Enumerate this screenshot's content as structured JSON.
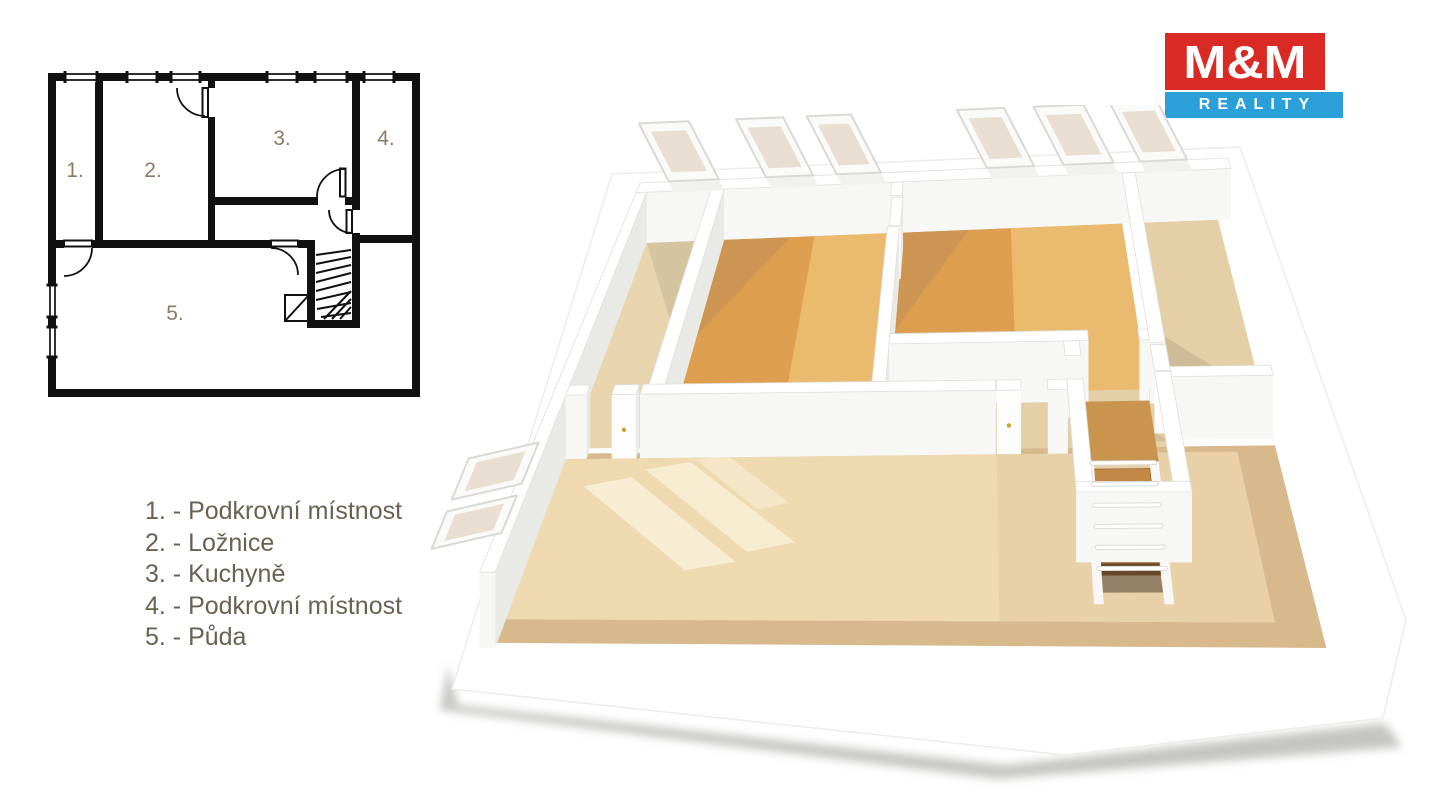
{
  "logo": {
    "top": "M&M",
    "bottom": "REALITY",
    "red": "#d92b23",
    "blue": "#2b9fd8"
  },
  "legend": {
    "items": [
      "1. - Podkrovní místnost",
      "2. - Ložnice",
      "3. - Kuchyně",
      "4. - Podkrovní místnost",
      "5. - Půda"
    ]
  },
  "plan2d": {
    "labels": [
      "1.",
      "2.",
      "3.",
      "4.",
      "5."
    ],
    "label_color": "#8b7c64"
  },
  "iso": {
    "quad": {
      "nw": [
        210,
        128
      ],
      "ne": [
        798,
        103
      ],
      "sw": [
        48,
        547
      ],
      "se": [
        918,
        553
      ]
    },
    "outline": [
      [
        182,
        69
      ],
      [
        810,
        42
      ],
      [
        976,
        515
      ],
      [
        953,
        613
      ],
      [
        635,
        650
      ],
      [
        22,
        584
      ]
    ],
    "ground_shadow": [
      [
        18,
        560
      ],
      [
        28,
        600
      ],
      [
        575,
        660
      ],
      [
        955,
        618
      ],
      [
        972,
        642
      ],
      [
        568,
        674
      ],
      [
        10,
        605
      ]
    ],
    "wall_h": [
      50,
      26
    ],
    "colors": {
      "wallFront": "#f7f7f5",
      "wallSide": "#e9e9e6",
      "wallTop": "#ffffff",
      "wallEdge": "#dededa",
      "woodLight": "#e8d4ad",
      "woodOrange": "#dd9e50",
      "woodOrangeLight": "#eaba6e",
      "woodTan": "#e4cfa7",
      "woodBand": "#d8b98c",
      "woodField": "#eed9b1",
      "stairWood": "#c9944e",
      "pane": "#e8dfd2",
      "frame": "#fafaf8",
      "frameEdge": "#d9d9d5",
      "door": "#fdfdfc",
      "handle": "#c9a227"
    },
    "floors": [
      {
        "n": "floor-room1",
        "r": [
          0.018,
          0.0247,
          0.126,
          0.515
        ],
        "c": "woodLight"
      },
      {
        "n": "floor-room2",
        "r": [
          0.148,
          0.0247,
          0.43,
          0.515
        ],
        "c": "woodOrange"
      },
      {
        "n": "floor-room2-light",
        "r": [
          0.3,
          0.0247,
          0.43,
          0.515
        ],
        "c": "woodOrangeLight"
      },
      {
        "n": "floor-room3",
        "r": [
          0.449,
          0.0247,
          0.817,
          0.398
        ],
        "c": "woodOrange"
      },
      {
        "n": "floor-room3-light",
        "r": [
          0.63,
          0.0247,
          0.817,
          0.398
        ],
        "c": "woodOrangeLight"
      },
      {
        "n": "floor-corridor",
        "r": [
          0.449,
          0.398,
          0.839,
          0.527
        ],
        "c": "woodTan"
      },
      {
        "n": "floor-room4",
        "r": [
          0.839,
          0.0247,
          0.978,
          0.5
        ],
        "c": "woodTan"
      },
      {
        "n": "floor-attic-band",
        "r": [
          0.018,
          0.527,
          0.978,
          0.978
        ],
        "c": "woodBand"
      },
      {
        "n": "floor-attic",
        "r": [
          0.018,
          0.54,
          0.925,
          0.922
        ],
        "c": "woodField"
      }
    ],
    "overlays": [
      {
        "n": "shade-attic-right",
        "p": [
          [
            0.6,
            0.54
          ],
          [
            0.925,
            0.54
          ],
          [
            0.925,
            0.922
          ],
          [
            0.6,
            0.922
          ]
        ],
        "f": "rgba(186,156,108,0.12)"
      },
      {
        "n": "sunlight-patch-1",
        "p": [
          [
            0.055,
            0.605
          ],
          [
            0.115,
            0.585
          ],
          [
            0.275,
            0.785
          ],
          [
            0.215,
            0.805
          ]
        ],
        "f": "rgba(255,250,233,0.6)"
      },
      {
        "n": "sunlight-patch-2",
        "p": [
          [
            0.13,
            0.567
          ],
          [
            0.188,
            0.55
          ],
          [
            0.345,
            0.74
          ],
          [
            0.287,
            0.762
          ]
        ],
        "f": "rgba(255,250,233,0.55)"
      },
      {
        "n": "sunlight-patch-3",
        "p": [
          [
            0.195,
            0.545
          ],
          [
            0.235,
            0.535
          ],
          [
            0.33,
            0.648
          ],
          [
            0.29,
            0.663
          ]
        ],
        "f": "rgba(255,250,233,0.4)"
      },
      {
        "n": "shadow-room1",
        "p": [
          [
            0.018,
            0.0247
          ],
          [
            0.126,
            0.0247
          ],
          [
            0.126,
            0.28
          ]
        ],
        "f": "rgba(120,112,96,0.16)"
      },
      {
        "n": "shadow-room2",
        "p": [
          [
            0.148,
            0.0247
          ],
          [
            0.26,
            0.0247
          ],
          [
            0.148,
            0.25
          ]
        ],
        "f": "rgba(120,112,96,0.16)"
      },
      {
        "n": "shadow-room3",
        "p": [
          [
            0.449,
            0.0247
          ],
          [
            0.56,
            0.0247
          ],
          [
            0.449,
            0.25
          ]
        ],
        "f": "rgba(120,112,96,0.16)"
      },
      {
        "n": "shadow-room4",
        "p": [
          [
            0.845,
            0.27
          ],
          [
            0.978,
            0.42
          ],
          [
            0.978,
            0.488
          ],
          [
            0.845,
            0.488
          ]
        ],
        "f": "rgba(120,112,96,0.2)"
      },
      {
        "n": "shadow-corridor",
        "p": [
          [
            0.731,
            0.423
          ],
          [
            0.839,
            0.515
          ],
          [
            0.731,
            0.515
          ]
        ],
        "f": "rgba(120,112,96,0.18)"
      }
    ],
    "walls": [
      {
        "n": "north-wall",
        "r": [
          0,
          0,
          1,
          0.0247
        ]
      },
      {
        "n": "west-wall",
        "r": [
          0,
          0.0247,
          0.018,
          0.99
        ]
      },
      {
        "n": "wall-room1-room2",
        "r": [
          0.126,
          0.0247,
          0.148,
          0.515
        ]
      },
      {
        "n": "wall-room2-room3-a",
        "r": [
          0.43,
          0.0247,
          0.449,
          0.058
        ]
      },
      {
        "n": "door-room2",
        "r": [
          0.433,
          0.062,
          0.451,
          0.132
        ],
        "door": true
      },
      {
        "n": "wall-room2-room3-b",
        "r": [
          0.43,
          0.135,
          0.449,
          0.515
        ]
      },
      {
        "n": "wall-room3-room4",
        "r": [
          0.817,
          0.0247,
          0.839,
          0.43
        ]
      },
      {
        "n": "door-room4",
        "r": [
          0.817,
          0.435,
          0.839,
          0.497
        ],
        "door": true
      },
      {
        "n": "wall-room3-corridor-a",
        "r": [
          0.449,
          0.398,
          0.731,
          0.423
        ]
      },
      {
        "n": "wall-room3-corridor-b",
        "r": [
          0.803,
          0.398,
          0.817,
          0.423
        ]
      },
      {
        "n": "stair-door-jamb",
        "r": [
          0.696,
          0.423,
          0.718,
          0.458
        ]
      },
      {
        "n": "wall-room4-bottom",
        "r": [
          0.839,
          0.488,
          0.978,
          0.512
        ]
      },
      {
        "n": "wall-attic-a",
        "r": [
          0.018,
          0.515,
          0.046,
          0.54
        ]
      },
      {
        "n": "door-attic-left",
        "r": [
          0.08,
          0.515,
          0.113,
          0.54
        ],
        "door": true
      },
      {
        "n": "wall-attic-b",
        "r": [
          0.118,
          0.515,
          0.599,
          0.54
        ]
      },
      {
        "n": "door-attic-right",
        "r": [
          0.6,
          0.515,
          0.633,
          0.54
        ],
        "door": true
      },
      {
        "n": "wall-attic-c",
        "r": [
          0.669,
          0.515,
          0.696,
          0.54
        ]
      }
    ],
    "walls2": [
      {
        "n": "stairwell-left-wall",
        "r": [
          0.696,
          0.515,
          0.718,
          0.787
        ]
      },
      {
        "n": "stairwell-right-wall",
        "r": [
          0.817,
          0.5,
          0.839,
          0.787
        ]
      },
      {
        "n": "stairwell-bottom-wall",
        "r": [
          0.696,
          0.762,
          0.839,
          0.787
        ]
      }
    ],
    "sky_n": [
      [
        0.05,
        0.135
      ],
      [
        0.215,
        0.295
      ],
      [
        0.335,
        0.41
      ],
      [
        0.59,
        0.67
      ],
      [
        0.72,
        0.805
      ],
      [
        0.85,
        0.93
      ]
    ],
    "sky_w": [
      [
        0.645,
        0.75
      ],
      [
        0.78,
        0.875
      ]
    ],
    "stairs": {
      "u0": 0.718,
      "u1": 0.817,
      "iu0": 0.73,
      "iu1": 0.805,
      "landing": [
        0.423,
        0.56
      ],
      "stepDv": 0.034,
      "steps": 5,
      "drop": 7,
      "stepColors": [
        "#c28846",
        "#b87e40",
        "#ad743a",
        "#a06a34",
        "#93602e"
      ],
      "pit": [
        0.7,
        0.765
      ],
      "pitDrop": 40,
      "pitFill": "rgba(60,48,36,0.5)",
      "bars": 6
    }
  }
}
